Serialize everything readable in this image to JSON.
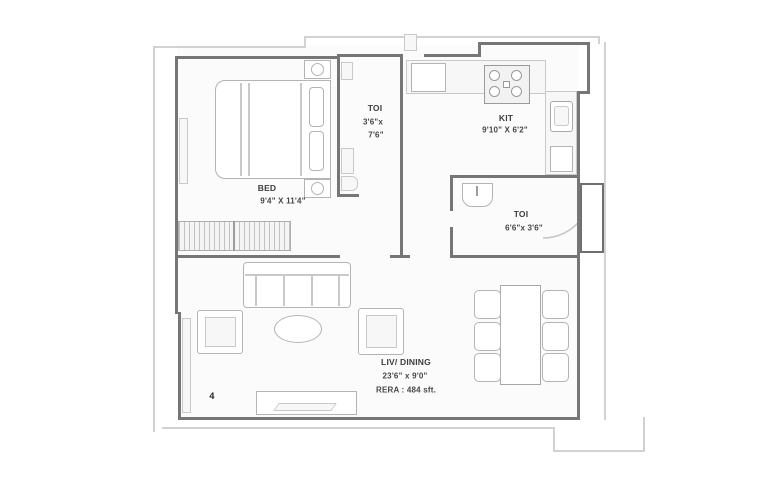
{
  "rooms": {
    "bed": {
      "label": "BED",
      "dims": "9'4\" X 11'4\""
    },
    "toilet_top": {
      "label": "TOI",
      "dims_line1": "3'6\"x",
      "dims_line2": "7'6\""
    },
    "kitchen": {
      "label": "KIT",
      "dims": "9'10\" X 6'2\""
    },
    "toilet_right": {
      "label": "TOI",
      "dims": "6'6\"x 3'6\""
    },
    "living_dining": {
      "label": "LIV/ DINING",
      "dims": "23'6\" x 9'0\"",
      "rera": "RERA : 484 sft."
    }
  },
  "unit_number": "4",
  "colors": {
    "wall": "#767676",
    "furniture_outline": "#b4b4b4",
    "boundary": "#d2d2d2",
    "text": "#3d3d3d",
    "background": "#ffffff"
  }
}
